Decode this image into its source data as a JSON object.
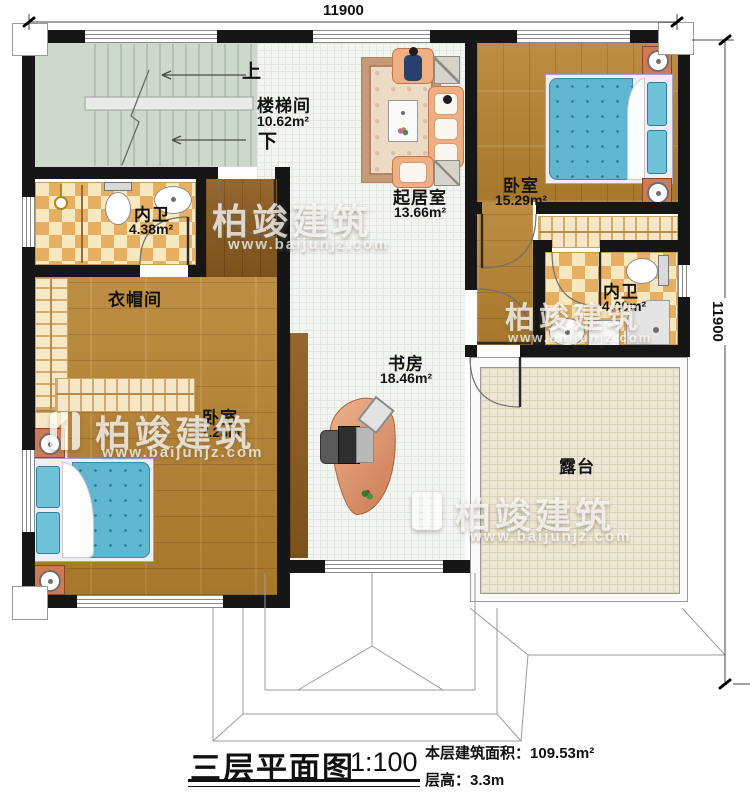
{
  "dimensions": {
    "top": "11900",
    "right": "11900"
  },
  "stairwell": {
    "name": "楼梯间",
    "area": "10.62m²",
    "up": "上",
    "down": "下"
  },
  "rooms": {
    "bath_left": {
      "name": "内卫",
      "area": "4.38m²"
    },
    "cloakroom": {
      "name": "衣帽间"
    },
    "bedroom_left": {
      "name": "卧室",
      "area": "27.28m²"
    },
    "living": {
      "name": "起居室",
      "area": "13.66m²"
    },
    "bedroom_right": {
      "name": "卧室",
      "area": "15.29m²"
    },
    "bath_right": {
      "name": "内卫",
      "area": "4.00m²"
    },
    "study": {
      "name": "书房",
      "area": "18.46m²"
    },
    "terrace": {
      "name": "露台"
    }
  },
  "title": {
    "name": "三层平面图",
    "scale": "1:100",
    "area_label": "本层建筑面积：",
    "area_value": "109.53m²",
    "height_label": "层高：",
    "height_value": "3.3m"
  },
  "watermark": {
    "brand": "柏竣建筑",
    "url": "www.baijunjz.com"
  },
  "colors": {
    "wall": "#161616",
    "wood_floor": "#b5812f",
    "tile_floor": "#f3f5f1",
    "terrace_floor": "#ece7d4",
    "stair_floor": "#cfd8cd",
    "checker_light": "#f8e8c0",
    "checker_dark": "#e6af62",
    "bed": "#5fb6ce",
    "sofa": "#f0ae83",
    "nightstand": "#cf7a52"
  }
}
